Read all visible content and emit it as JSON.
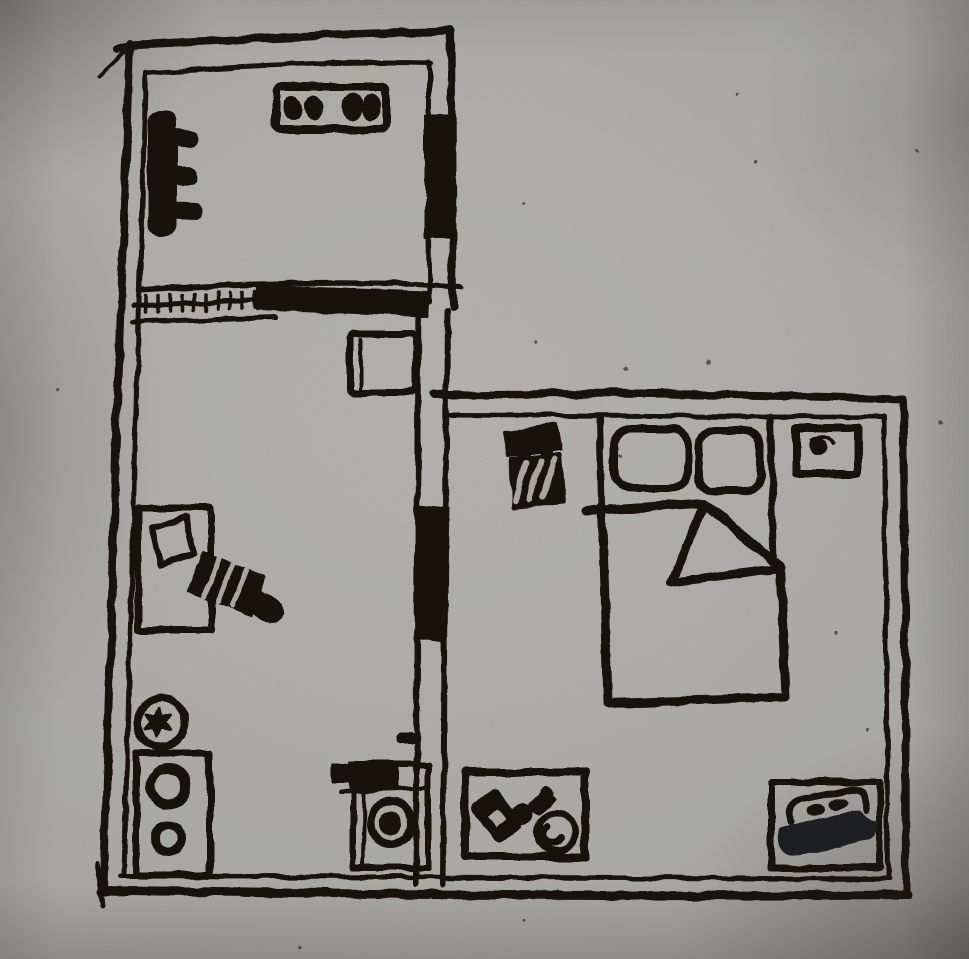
{
  "drawing": {
    "kind": "hand-drawn apartment floor plan sketch, black ink on gray paper",
    "caption": "hand-drawn apartment floor plan"
  },
  "palette": {
    "paper": "#c7c6c2",
    "paper_highlight": "#d4d3cf",
    "ink": "#1b1510",
    "dark_slab": "#23262a"
  },
  "floor_plan": {
    "shape": "L-shaped apartment, double-line walls",
    "rooms": [
      {
        "name": "kitchen",
        "position": "top-left",
        "furniture": [
          "stove-with-four-burners",
          "radiator-on-left-wall",
          "wide-doorway-with-hatched-threshold"
        ]
      },
      {
        "name": "study",
        "position": "middle-left",
        "furniture": [
          "small-side-table",
          "desk-with-sheet-of-paper",
          "office-chair",
          "potted-plant",
          "cabinet-with-two-bowls"
        ]
      },
      {
        "name": "utility-corner",
        "position": "bottom-center",
        "furniture": [
          "washing-machine-with-round-door"
        ]
      },
      {
        "name": "bedroom",
        "position": "right",
        "furniture": [
          "armchair",
          "double-bed-with-two-pillows-and-folded-blanket",
          "nightstand",
          "low-table-with-phone-key-and-bowl",
          "bench-with-slippers"
        ]
      }
    ]
  }
}
